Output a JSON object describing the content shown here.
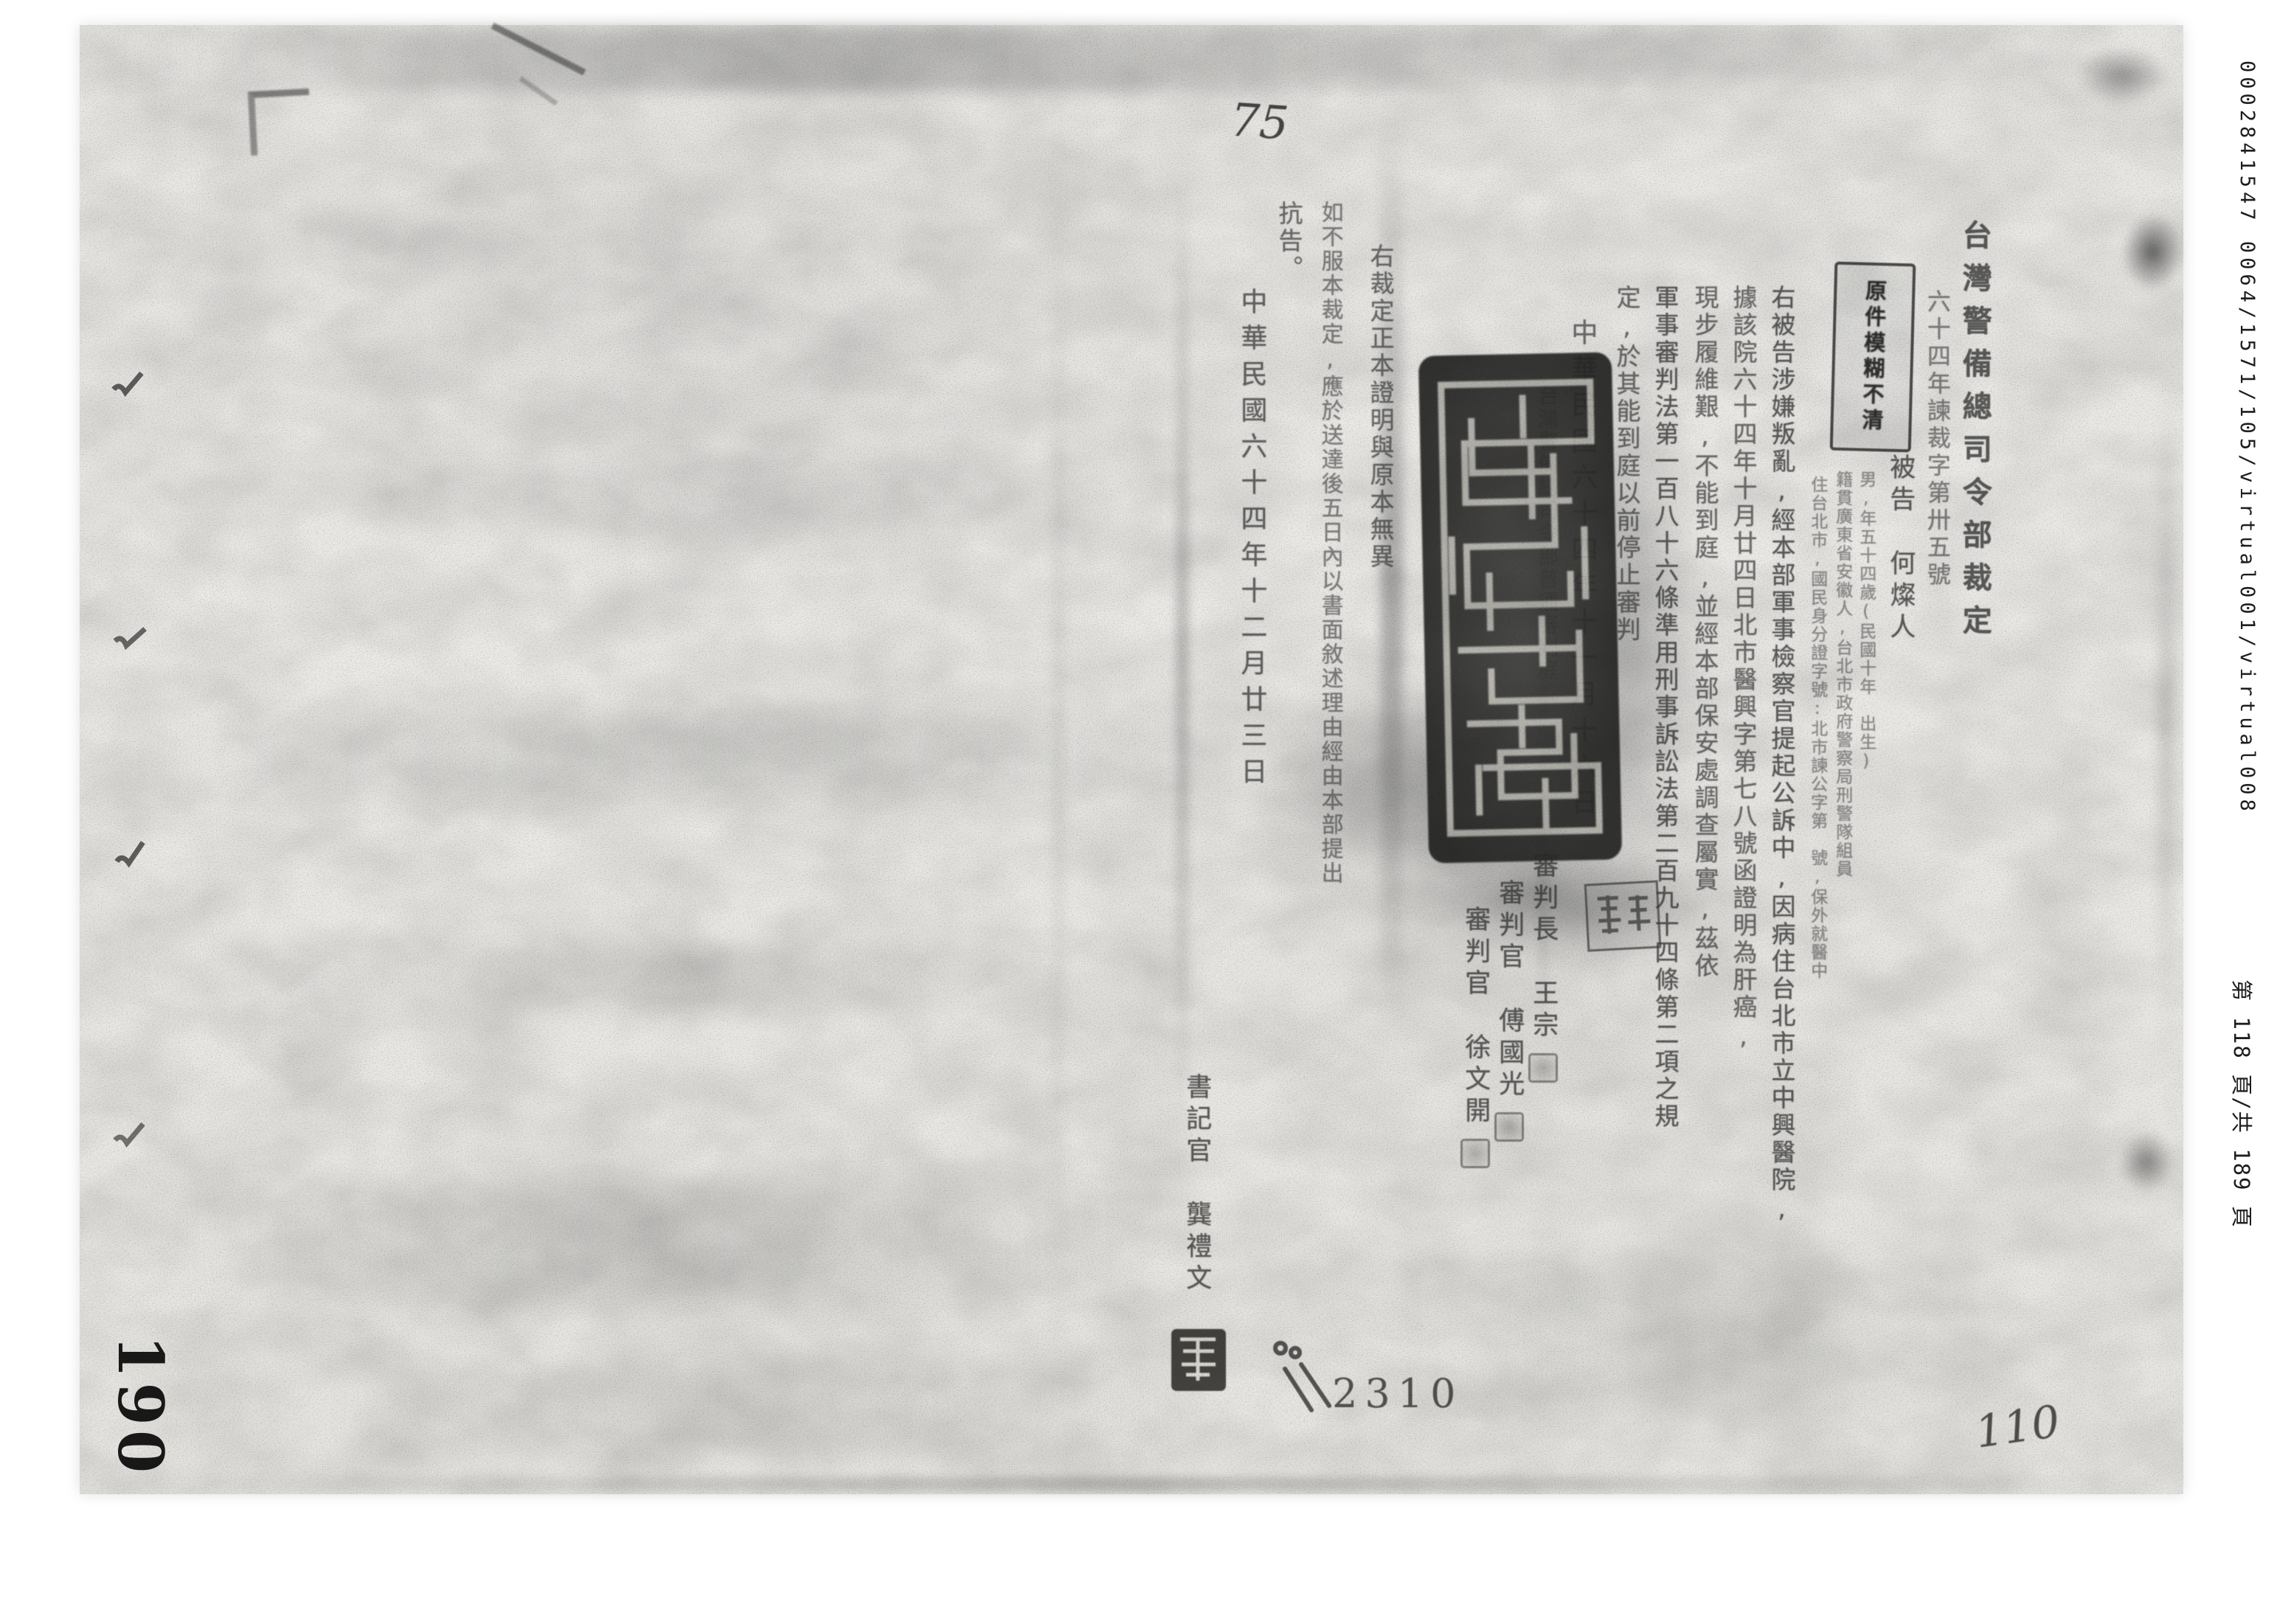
{
  "scan": {
    "folio_number": "190",
    "handwritten_note_top": "75",
    "handwritten_note_bottom": "110",
    "stamped_number": "2310",
    "edge_reference": "0002841547  0064/1571/105/virtual001/virtual008",
    "edge_page_label": "第 118 頁/共 189 頁",
    "blur_notice_stamp": "原件模糊不清"
  },
  "ruling": {
    "title": "台灣警備總司令部裁定",
    "case_number": "六十四年諫裁字第卅五號",
    "defendant_label": "被告",
    "defendant_name": "何燦人",
    "defendant_details": [
      "男,年五十四歲(民國十年　出生)",
      "籍貫廣東省安徽人,台北市政府警察局刑警隊組員",
      "住台北市,國民身分證字號:北市諫公字第　號,保外就醫中"
    ],
    "body_lines": [
      "右被告涉嫌叛亂,經本部軍事檢察官提起公訴中,因病住台北市立中興醫院,",
      "據該院六十四年十月廿四日北市醫興字第七八號函證明為肝癌,",
      "現步履維艱,不能到庭,並經本部保安處調查屬實,茲依",
      "軍事審判法第一百八十六條準用刑事訴訟法第二百九十四條第二項之規",
      "定,於其能到庭以前停止審判"
    ],
    "ruling_date": "中華民國六十四年十一月十六日",
    "court_name": "台灣警備總司令部普通審判庭",
    "judges": [
      {
        "role": "審判長",
        "name": "王宗"
      },
      {
        "role": "審判官",
        "name": "傅國光"
      },
      {
        "role": "審判官",
        "name": "徐文開"
      }
    ]
  },
  "certification": {
    "line_1": "右裁定正本證明與原本無異",
    "line_2": "如不服本裁定,應於送達後五日內以書面敘述理由經由本部提出",
    "line_3": "抗告。",
    "date": "中華民國六十四年十二月廿三日",
    "clerk_label": "書記官",
    "clerk_name": "龔禮文"
  }
}
